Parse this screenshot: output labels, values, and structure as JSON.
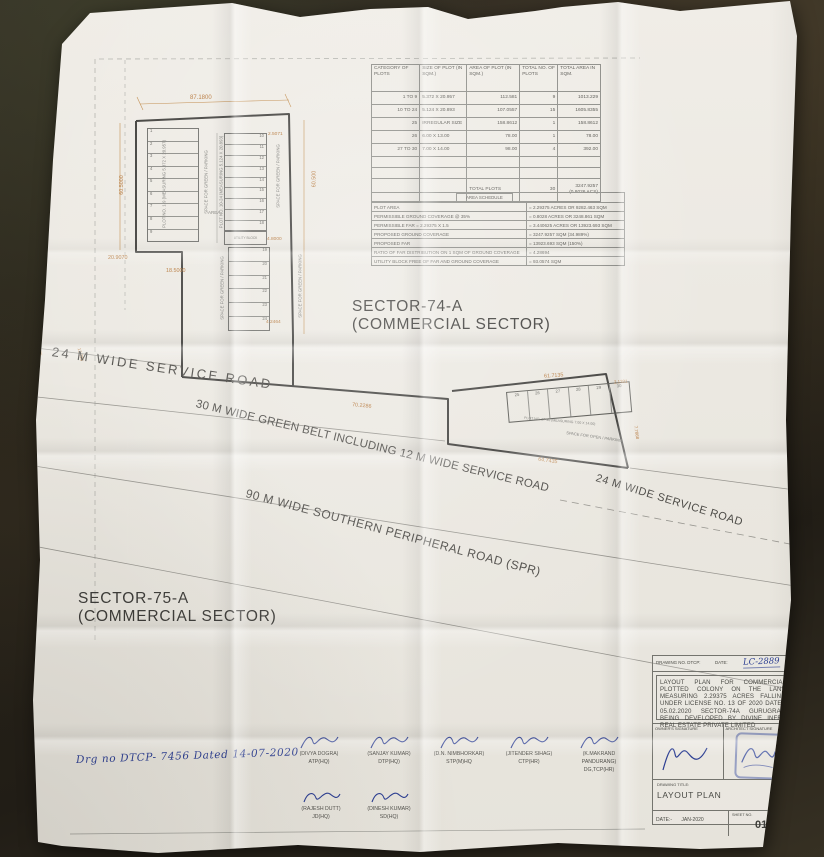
{
  "plan": {
    "sector74_line1": "SECTOR-74-A",
    "sector74_line2": "(COMMERCIAL SECTOR)",
    "sector75_line1": "SECTOR-75-A",
    "sector75_line2": "(COMMERCIAL SECTOR)",
    "roads": {
      "service_upper": "24 M WIDE SERVICE ROAD",
      "green_belt": "30 M WIDE GREEN BELT INCLUDING 12 M WIDE SERVICE ROAD",
      "spr": "90 M WIDE SOUTHERN PERIPHERAL ROAD (SPR)",
      "service_lower": "24 M WIDE SERVICE ROAD"
    },
    "labels": {
      "plot_1_9": "PLOT NO. 1-9 (MEASURING 5.372 X 20.957)",
      "plot_10_24": "PLOT NO. 10-24 (MEASURING 5.124 X 20.893)",
      "plot_27_30": "PLOT NO. 27-30 (MEASURING 7.00 X 14.00)",
      "space_green": "SPACE FOR GREEN / PARKING",
      "space_open": "SPACE FOR OPEN / PARKING",
      "utility_block": "UTILITY BLOCK",
      "area": "AREA"
    },
    "plot_numbers": {
      "left": [
        "1",
        "2",
        "3",
        "4",
        "5",
        "6",
        "7",
        "8",
        "9"
      ],
      "right": [
        "10",
        "11",
        "12",
        "13",
        "14",
        "15",
        "16",
        "17",
        "18"
      ],
      "lower": [
        "19",
        "20",
        "21",
        "22",
        "23",
        "24"
      ],
      "bottom": [
        "25",
        "26",
        "27",
        "28",
        "29",
        "30"
      ]
    },
    "dims": {
      "top": "87.1800",
      "left": "60.5000",
      "right": "60.500",
      "step": "20.9070",
      "inner": "18.5000",
      "corner_a": "2.5071",
      "corner_b": "4.8000",
      "corner_c": "4.2464",
      "strip": "70.2286",
      "lower_top": "61.7135",
      "lower_bottom": "64.7435",
      "lower_right_a": "2.1331",
      "lower_right_b": "7.7868",
      "edge_a": "12.05",
      "edge_b": "13.726"
    },
    "dimension_color": "#b5773a"
  },
  "plot_table": {
    "headers": [
      "CATEGORY OF PLOTS",
      "SIZE OF PLOT (IN SQM.)",
      "AREA OF PLOT (IN SQM.)",
      "TOTAL NO. OF PLOTS",
      "TOTAL AREA IN SQM."
    ],
    "rows": [
      [
        "1 TO 9",
        "5.372 X 20.957",
        "112.581",
        "9",
        "1013.229"
      ],
      [
        "10 TO 24",
        "5.124 X 20.893",
        "107.0557",
        "15",
        "1605.8355"
      ],
      [
        "25",
        "IRREGULAR SIZE",
        "158.8612",
        "1",
        "158.8612"
      ],
      [
        "26",
        "6.00 X 13.00",
        "78.00",
        "1",
        "78.00"
      ],
      [
        "27 TO 30",
        "7.00 X 14.00",
        "98.00",
        "4",
        "392.00"
      ]
    ],
    "total_row": {
      "label": "TOTAL PLOTS",
      "plots": "30",
      "area_line1": "3247.9257",
      "area_line2": "(0.8026 ACS)"
    }
  },
  "area_schedule": {
    "title": "AREA SCHEDULE",
    "rows": [
      [
        "PLOT AREA",
        "= 2.29375 ACRES OR 9282.463 SQM"
      ],
      [
        "PERMISSIBLE GROUND COVERAGE @ 35%",
        "= 0.8028 ACRES OR 3248.861 SQM"
      ],
      [
        "PERMISSIBLE FAR = 2.29375 X 1.5",
        "= 3.440625 ACRES OR 13923.693 SQM"
      ],
      [
        "PROPOSED GROUND COVERAGE",
        "= 3247.9257 SQM (34.989%)"
      ],
      [
        "PROPOSED FAR",
        "= 13923.693 SQM (150%)"
      ],
      [
        "RATIO OF FAR DISTRIBUTION ON 1 SQM OF GROUND COVERAGE",
        "= 4.28694"
      ],
      [
        "UTILITY BLOCK FREE OF FAR AND GROUND COVERAGE",
        "= 93.0574 SQM"
      ]
    ]
  },
  "title_block": {
    "drawing_no_label": "DRAWING NO. DTCP:",
    "date_label": "DATE:",
    "drawing_no_handwritten": "LC-2889",
    "description": "LAYOUT PLAN FOR COMMERCIAL PLOTTED COLONY ON THE LAND MEASURING 2.29375 ACRES FALLING UNDER LICENSE NO. 13 OF 2020 DATED 05.02.2020 SECTOR-74A GURUGRAM BEING DEVELOPED BY DIVINE INFRA REAL ESTATE PRIVATE LIMITED",
    "owner_sig_label": "OWNER'S SIGNATURE",
    "architect_sig_label": "ARCHITECT SIGNATURE",
    "drawing_title_label": "DRAWING TITLE:",
    "drawing_title": "LAYOUT PLAN",
    "date_label2": "DATE:-",
    "date_value": "JAN-2020",
    "sheet_label": "SHEET NO.",
    "sheet_value": "01A"
  },
  "approvals": {
    "handwritten_note": "Drg no DTCP- 7456 Dated 14-07-2020",
    "row1": [
      {
        "name": "(DIVYA DOGRA)",
        "title": "ATP(HQ)"
      },
      {
        "name": "(SANJAY KUMAR)",
        "title": "DTP(HQ)"
      },
      {
        "name": "(D.N. NIMBHORKAR)",
        "title": "STP(M)HQ"
      },
      {
        "name": "(JITENDER SIHAG)",
        "title": "CTP(HR)"
      },
      {
        "name": "(K.MAKRAND PANDURANG)",
        "title": "DG,TCP(HR)"
      }
    ],
    "row2": [
      {
        "name": "(RAJESH DUTT)",
        "title": "JD(HQ)"
      },
      {
        "name": "(DINESH KUMAR)",
        "title": "SD(HQ)"
      }
    ]
  }
}
